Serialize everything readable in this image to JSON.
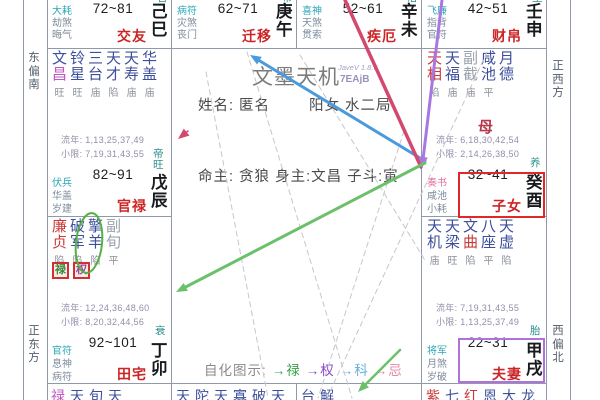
{
  "app": {
    "title": "文墨天机",
    "version_small": "JaveV 1.8.6",
    "version_code": "7EAjB"
  },
  "center": {
    "name_line": "姓名: 匿名",
    "gender_line": "阳女 水二局",
    "master_line": "命主: 贪狼 身主:文昌 子斗:寅",
    "legend_title": "自化图示:",
    "legend_items": [
      {
        "label": "→禄",
        "color": "#3aa04a"
      },
      {
        "label": "→权",
        "color": "#8d49c8"
      },
      {
        "label": "→科",
        "color": "#63aede"
      },
      {
        "label": "→忌",
        "color": "#e687a8"
      }
    ]
  },
  "directions": {
    "left_top": "东偏南",
    "left_bottom": "正东方",
    "right_top": "正西方",
    "right_bottom": "西偏北"
  },
  "palette": {
    "navy": "#3d4f9c",
    "red": "#c83a3a",
    "gray": "#9aa2ac",
    "cyan": "#2aa7b8",
    "pink": "#e0739c",
    "god": "#7e8c9c",
    "magenta": "#c257c2"
  },
  "palaces": [
    {
      "type": "top",
      "col": 0,
      "range": "72~81",
      "name": "交友",
      "ganzhi": [
        "己",
        "巳"
      ],
      "changsheng_partial": "官",
      "gods": [
        {
          "t": "大耗",
          "c": "cyan"
        },
        {
          "t": "劫煞",
          "c": "god"
        },
        {
          "t": "晦气",
          "c": "god"
        }
      ]
    },
    {
      "type": "top",
      "col": 1,
      "range": "62~71",
      "name": "迁移",
      "ganzhi": [
        "庚",
        "午"
      ],
      "changsheng_partial": "带",
      "gods": [
        {
          "t": "病符",
          "c": "cyan"
        },
        {
          "t": "灾煞",
          "c": "god"
        },
        {
          "t": "丧门",
          "c": "god"
        }
      ]
    },
    {
      "type": "top",
      "col": 2,
      "range": "52~61",
      "name": "疾厄",
      "ganzhi": [
        "辛",
        "未"
      ],
      "changsheng_partial": "浴",
      "gods": [
        {
          "t": "喜神",
          "c": "cyan"
        },
        {
          "t": "天煞",
          "c": "god"
        },
        {
          "t": "贯索",
          "c": "god"
        }
      ]
    },
    {
      "type": "top",
      "col": 3,
      "range": "42~51",
      "name": "财帛",
      "ganzhi": [
        "壬",
        "申"
      ],
      "changsheng_partial": "生",
      "gods": [
        {
          "t": "飞廉",
          "c": "cyan"
        },
        {
          "t": "指背",
          "c": "god"
        },
        {
          "t": "官符",
          "c": "god"
        }
      ]
    },
    {
      "type": "full",
      "row": 1,
      "col": 0,
      "range": "82~91",
      "name": "官禄",
      "ganzhi": [
        "戊",
        "辰"
      ],
      "changsheng": [
        "帝",
        "旺"
      ],
      "stars": [
        {
          "chars": [
            "文",
            "昌"
          ],
          "colors": [
            "navy",
            "magenta"
          ],
          "status": "旺"
        },
        {
          "chars": [
            "铃",
            "星"
          ],
          "colors": [
            "navy",
            "navy"
          ],
          "status": "旺"
        },
        {
          "chars": [
            "三",
            "台"
          ],
          "colors": [
            "navy",
            "navy"
          ],
          "status": "庙"
        },
        {
          "chars": [
            "天",
            "才"
          ],
          "colors": [
            "navy",
            "navy"
          ],
          "status": "陷"
        },
        {
          "chars": [
            "天",
            "寿"
          ],
          "colors": [
            "navy",
            "navy"
          ],
          "status": "庙"
        },
        {
          "chars": [
            "华",
            "盖"
          ],
          "colors": [
            "navy",
            "navy"
          ],
          "status": "庙"
        }
      ],
      "liunian": "流年: 1,13,25,37,49",
      "xiaoxian": "小限: 7,19,31,43,55",
      "gods": [
        {
          "t": "伏兵",
          "c": "cyan"
        },
        {
          "t": "华盖",
          "c": "god"
        },
        {
          "t": "岁建",
          "c": "god"
        }
      ]
    },
    {
      "type": "full",
      "row": 1,
      "col": 3,
      "range": "32~41",
      "name": "子女",
      "ganzhi": [
        "癸",
        "酉"
      ],
      "changsheng": [
        "养"
      ],
      "stars": [
        {
          "chars": [
            "天",
            "相"
          ],
          "colors": [
            "red",
            "red"
          ],
          "status": "陷"
        },
        {
          "chars": [
            "天",
            "福"
          ],
          "colors": [
            "navy",
            "navy"
          ],
          "status": "庙"
        },
        {
          "chars": [
            "副",
            "截"
          ],
          "colors": [
            "gray",
            "gray"
          ],
          "status": "庙"
        },
        {
          "chars": [
            "咸",
            "池"
          ],
          "colors": [
            "navy",
            "navy"
          ],
          "status": "平"
        },
        {
          "chars": [
            "月",
            "德"
          ],
          "colors": [
            "navy",
            "navy"
          ]
        }
      ],
      "marker": "母",
      "liunian": "流年: 6,18,30,42,54",
      "xiaoxian": "小限: 2,14,26,38,50",
      "gods": [
        {
          "t": "奏书",
          "c": "pink"
        },
        {
          "t": "咸池",
          "c": "god"
        },
        {
          "t": "小耗",
          "c": "god"
        }
      ]
    },
    {
      "type": "full",
      "row": 2,
      "col": 0,
      "range": "92~101",
      "name": "田宅",
      "ganzhi": [
        "丁",
        "卯"
      ],
      "changsheng": [
        "衰"
      ],
      "stars": [
        {
          "chars": [
            "廉",
            "贞"
          ],
          "colors": [
            "red",
            "red"
          ],
          "status": "陷"
        },
        {
          "chars": [
            "破",
            "军"
          ],
          "colors": [
            "navy",
            "navy"
          ],
          "status": "陷"
        },
        {
          "chars": [
            "擎",
            "羊"
          ],
          "colors": [
            "navy",
            "navy"
          ],
          "status": "陷"
        },
        {
          "chars": [
            "副",
            "旬"
          ],
          "colors": [
            "gray",
            "gray"
          ],
          "status": "平"
        }
      ],
      "hua_tags": [
        {
          "t": "禄",
          "c": "#3a8a3a"
        },
        {
          "t": "权",
          "c": "#99409a"
        }
      ],
      "liunian": "流年: 12,24,36,48,60",
      "xiaoxian": "小限: 8,20,32,44,56",
      "gods": [
        {
          "t": "官符",
          "c": "cyan"
        },
        {
          "t": "息神",
          "c": "god"
        },
        {
          "t": "病符",
          "c": "god"
        }
      ]
    },
    {
      "type": "full",
      "row": 2,
      "col": 3,
      "range": "22~31",
      "name": "夫妻",
      "ganzhi": [
        "甲",
        "戌"
      ],
      "changsheng": [
        "胎"
      ],
      "stars": [
        {
          "chars": [
            "天",
            "机"
          ],
          "colors": [
            "navy",
            "navy"
          ],
          "status": "庙"
        },
        {
          "chars": [
            "天",
            "梁"
          ],
          "colors": [
            "navy",
            "navy"
          ],
          "status": "旺"
        },
        {
          "chars": [
            "文",
            "曲"
          ],
          "colors": [
            "navy",
            "red"
          ],
          "status": "陷"
        },
        {
          "chars": [
            "八",
            "座"
          ],
          "colors": [
            "navy",
            "navy"
          ],
          "status": "平"
        },
        {
          "chars": [
            "天",
            "虚"
          ],
          "colors": [
            "navy",
            "navy"
          ],
          "status": "陷"
        }
      ],
      "liunian": "流年: 7,19,31,43,55",
      "xiaoxian": "小限: 1,13,25,37,49",
      "gods": [
        {
          "t": "将军",
          "c": "cyan"
        },
        {
          "t": "月煞",
          "c": "god"
        },
        {
          "t": "岁破",
          "c": "god"
        }
      ]
    },
    {
      "type": "bottom",
      "col": 0,
      "chars": [
        {
          "t": "禄",
          "c": "magenta"
        },
        {
          "t": "天",
          "c": "navy"
        },
        {
          "t": "旬",
          "c": "navy"
        },
        {
          "t": "天",
          "c": "navy"
        }
      ]
    },
    {
      "type": "bottom",
      "col": 1,
      "chars": [
        {
          "t": "天",
          "c": "navy"
        },
        {
          "t": "陀",
          "c": "navy"
        },
        {
          "t": "天",
          "c": "navy"
        },
        {
          "t": "寡",
          "c": "navy"
        },
        {
          "t": "破",
          "c": "navy"
        },
        {
          "t": "天",
          "c": "navy"
        }
      ]
    },
    {
      "type": "bottom",
      "col": 2,
      "chars": [
        {
          "t": "台",
          "c": "navy"
        },
        {
          "t": "解",
          "c": "navy"
        }
      ]
    },
    {
      "type": "bottom",
      "col": 3,
      "chars": [
        {
          "t": "紫",
          "c": "red"
        },
        {
          "t": "七",
          "c": "navy"
        },
        {
          "t": "红",
          "c": "red"
        },
        {
          "t": "恩",
          "c": "navy"
        },
        {
          "t": "大",
          "c": "navy"
        },
        {
          "t": "龙",
          "c": "navy"
        }
      ]
    }
  ],
  "annotations": {
    "arrows": [
      {
        "name": "ke-arrow-blue",
        "from": [
          425,
          161
        ],
        "to": [
          250,
          55
        ],
        "color": "#4a9ade",
        "w": 3,
        "head": true
      },
      {
        "name": "ji-line-crimson",
        "from": [
          345,
          0
        ],
        "to": [
          421,
          167
        ],
        "color": "#d4486e",
        "w": 3.5,
        "head": false
      },
      {
        "name": "quan-arrow-purple",
        "from": [
          442,
          0
        ],
        "to": [
          422,
          168
        ],
        "color": "#a878e0",
        "w": 3,
        "head": true
      },
      {
        "name": "lu-arrow-green",
        "from": [
          425,
          163
        ],
        "to": [
          176,
          292
        ],
        "color": "#6cc06c",
        "w": 3,
        "head": true
      },
      {
        "name": "green-arrow-short",
        "from": [
          400,
          350
        ],
        "to": [
          358,
          392
        ],
        "color": "#6cc06c",
        "w": 2.5,
        "head": true
      },
      {
        "name": "mini-crimson-arrow",
        "from": [
          188,
          131
        ],
        "to": [
          178,
          139
        ],
        "color": "#d4486e",
        "w": 1.5,
        "head": true
      }
    ],
    "dashed": [
      [
        247,
        52,
        352,
        398
      ],
      [
        487,
        52,
        327,
        398
      ],
      [
        206,
        72,
        268,
        398
      ],
      [
        404,
        131,
        318,
        398
      ],
      [
        300,
        55,
        426,
        262
      ]
    ],
    "boxes": [
      {
        "name": "selected-palace-highlight-red",
        "x": 458,
        "y": 172,
        "w": 88,
        "h": 47,
        "color": "#e02828"
      },
      {
        "name": "selected-palace-highlight-purple",
        "x": 458,
        "y": 338,
        "w": 88,
        "h": 46,
        "color": "#b070e0"
      }
    ],
    "ellipse": {
      "cx": 89,
      "cy": 243,
      "rx": 13,
      "ry": 30,
      "rot": 6,
      "color": "#55b044"
    }
  }
}
